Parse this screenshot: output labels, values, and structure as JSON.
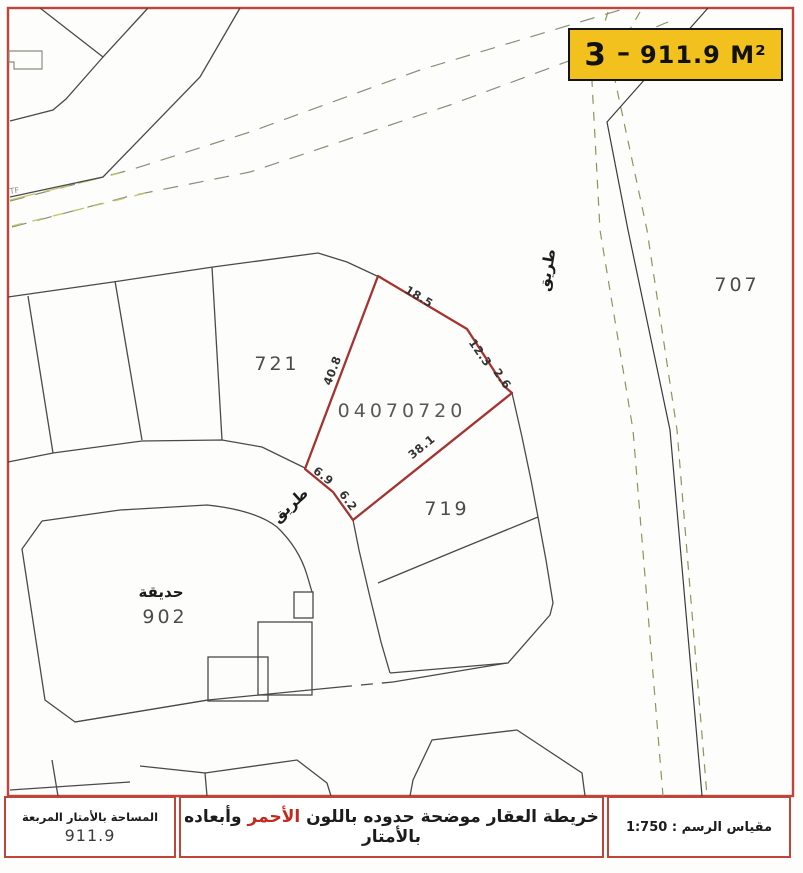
{
  "badge": {
    "number": "3",
    "separator": "–",
    "area": "911.9 M²"
  },
  "map": {
    "parcel_number": "04070720",
    "plots": {
      "left_block": "721",
      "right_block": "707",
      "lower_block": "719",
      "garden_label": "حديقة",
      "garden_number": "902"
    },
    "roads": {
      "curved_road": "طريق",
      "vertical_road": "طريق"
    },
    "marker": "TF",
    "dimensions": {
      "top": "18.5",
      "upper_right": "12.3",
      "right": "2.6",
      "left": "40.8",
      "bottom": "38.1",
      "corner_a": "6.9",
      "corner_b": "6.2"
    },
    "colors": {
      "boundary_red": "#a33431",
      "frame_red": "#c0443a",
      "road_dash_green": "#85995c",
      "diagonal_dash_grey": "#8a9077",
      "badge_yellow": "#f2c11e"
    }
  },
  "footer": {
    "area_label": "المساحة بالأمتار المربعة",
    "area_value": "911.9",
    "note_prefix": "خريطة العقار موضحة حدوده باللون ",
    "note_red": "الأحمر",
    "note_suffix": " وأبعاده بالأمتار",
    "scale_text": "مقياس الرسم : 1:750"
  }
}
